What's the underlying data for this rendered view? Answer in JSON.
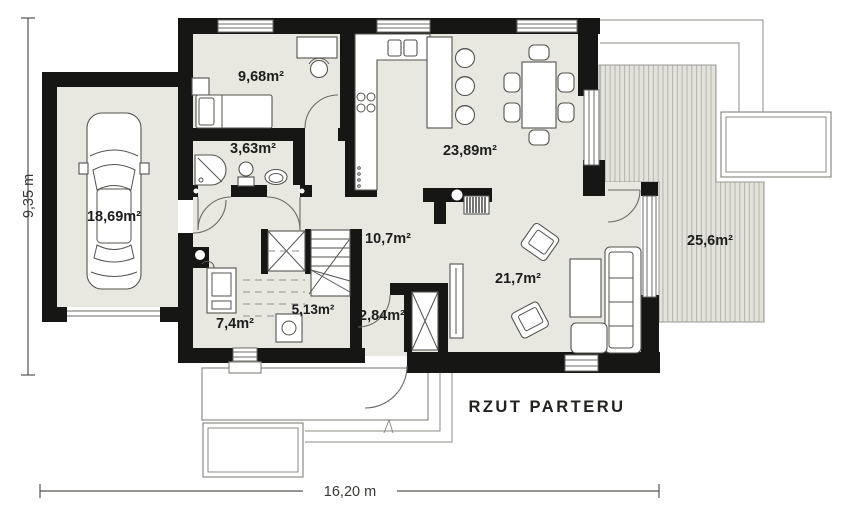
{
  "title": "RZUT PARTERU",
  "dimensions": {
    "height_label": "9,35 m",
    "width_label": "16,20 m"
  },
  "rooms": [
    {
      "id": "garage",
      "area_label": "18,69m²"
    },
    {
      "id": "bedroom",
      "area_label": "9,68m²"
    },
    {
      "id": "bathroom",
      "area_label": "3,63m²"
    },
    {
      "id": "kitchen-dining",
      "area_label": "23,89m²"
    },
    {
      "id": "hall",
      "area_label": "10,7m²"
    },
    {
      "id": "staircase",
      "area_label": "5,13m²"
    },
    {
      "id": "utility-room",
      "area_label": "7,4m²"
    },
    {
      "id": "vestibule",
      "area_label": "2,84m²"
    },
    {
      "id": "living-room",
      "area_label": "21,7m²"
    },
    {
      "id": "terrace",
      "area_label": "25,6m²"
    }
  ],
  "colors": {
    "wall": "#161614",
    "floor": "#e8e8e1",
    "terrace_fill": "#e3e3dc",
    "terrace_stripe": "#b8b8b1",
    "outline": "#8b8b86",
    "text": "#1d1d1b"
  }
}
